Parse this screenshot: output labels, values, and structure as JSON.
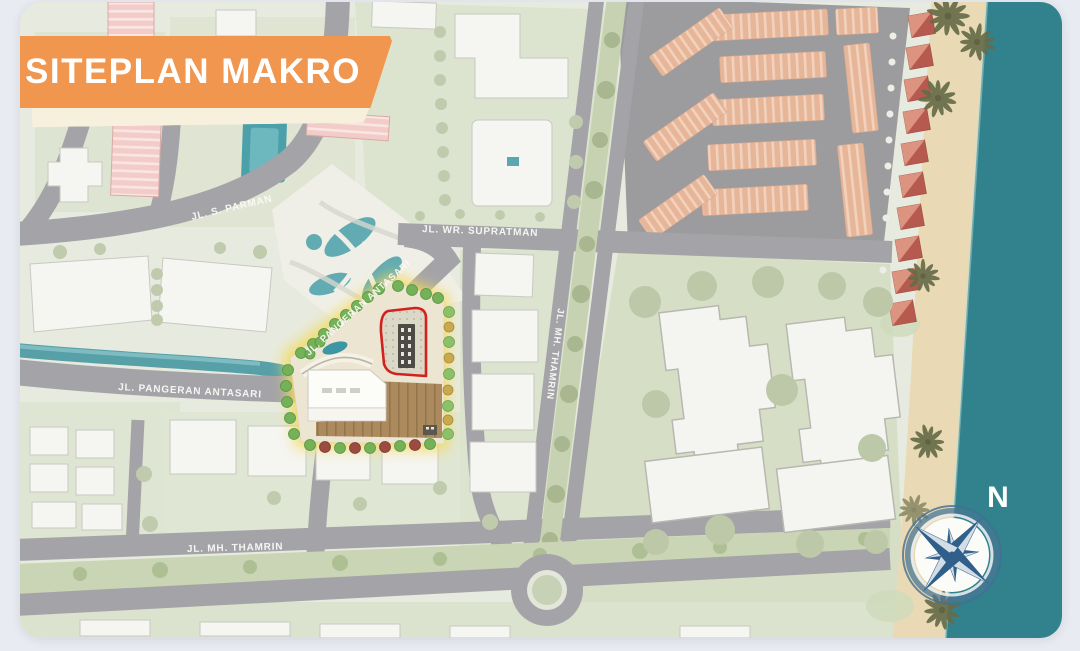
{
  "page": {
    "background_color": "#e9ebf2"
  },
  "banner": {
    "title": "SITEPLAN MAKRO",
    "background_color": "#f0964f",
    "text_color": "#ffffff"
  },
  "road_labels": {
    "s_parman": "JL. S. PARMAN",
    "wr_supratman": "JL. WR. SUPRATMAN",
    "mh_thamrin_vertical": "JL. MH. THAMRIN",
    "pangeran_antasari_horizontal": "JL. PANGERAN ANTASARI",
    "pangeran_antasari_diagonal": "JL. PANGERAN ANTASARI",
    "mh_thamrin_bottom": "JL. MH. THAMRIN"
  },
  "compass": {
    "north_label": "N"
  },
  "map_colors": {
    "ocean": "#31828d",
    "sand": "#e9dab5",
    "road": "#a4a4a8",
    "canal": "#57a0a8",
    "site_highlight_glow": "#f3da5e",
    "site_boundary_red": "#d2211e",
    "shophouse_block": "#e7b699",
    "villa_roof": "#b65a50",
    "lawn": "#d6dfc5",
    "vivid_tree": "#74b158",
    "building_white": "#f5f5f1"
  }
}
